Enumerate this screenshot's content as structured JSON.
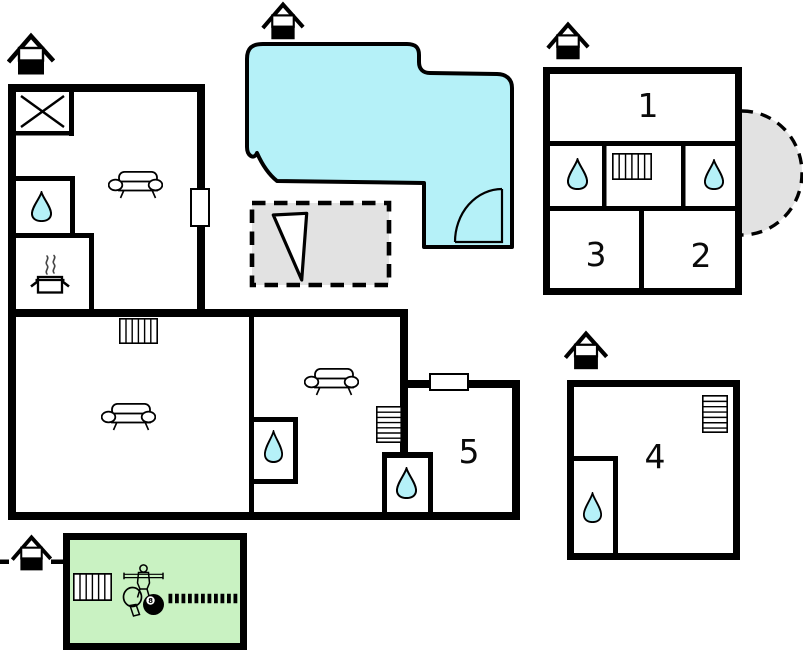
{
  "floorplan": {
    "background": "#ffffff",
    "line_color": "#000000",
    "colors": {
      "water": "#b5f1f8",
      "terrace_gray": "#e2e2e2",
      "games_room_green": "#c9f2c2"
    },
    "room_labels": {
      "room1": "1",
      "room2": "2",
      "room3": "3",
      "room4": "4",
      "room5": "5"
    },
    "billiard_ball_label": "8",
    "icons": {
      "house": "house-with-chimney entrance marker",
      "water_drop": "bathroom / water point",
      "radiator": "radiator",
      "sofa": "sofa",
      "cooking_pot": "kitchen stove pot",
      "cross": "crossed storage square",
      "door_swing": "door swing arc",
      "pennant": "pennant triangle on terrace",
      "foosball_player": "table football player",
      "table_tennis_paddle": "table tennis paddle",
      "billiard_ball": "8-ball"
    }
  }
}
